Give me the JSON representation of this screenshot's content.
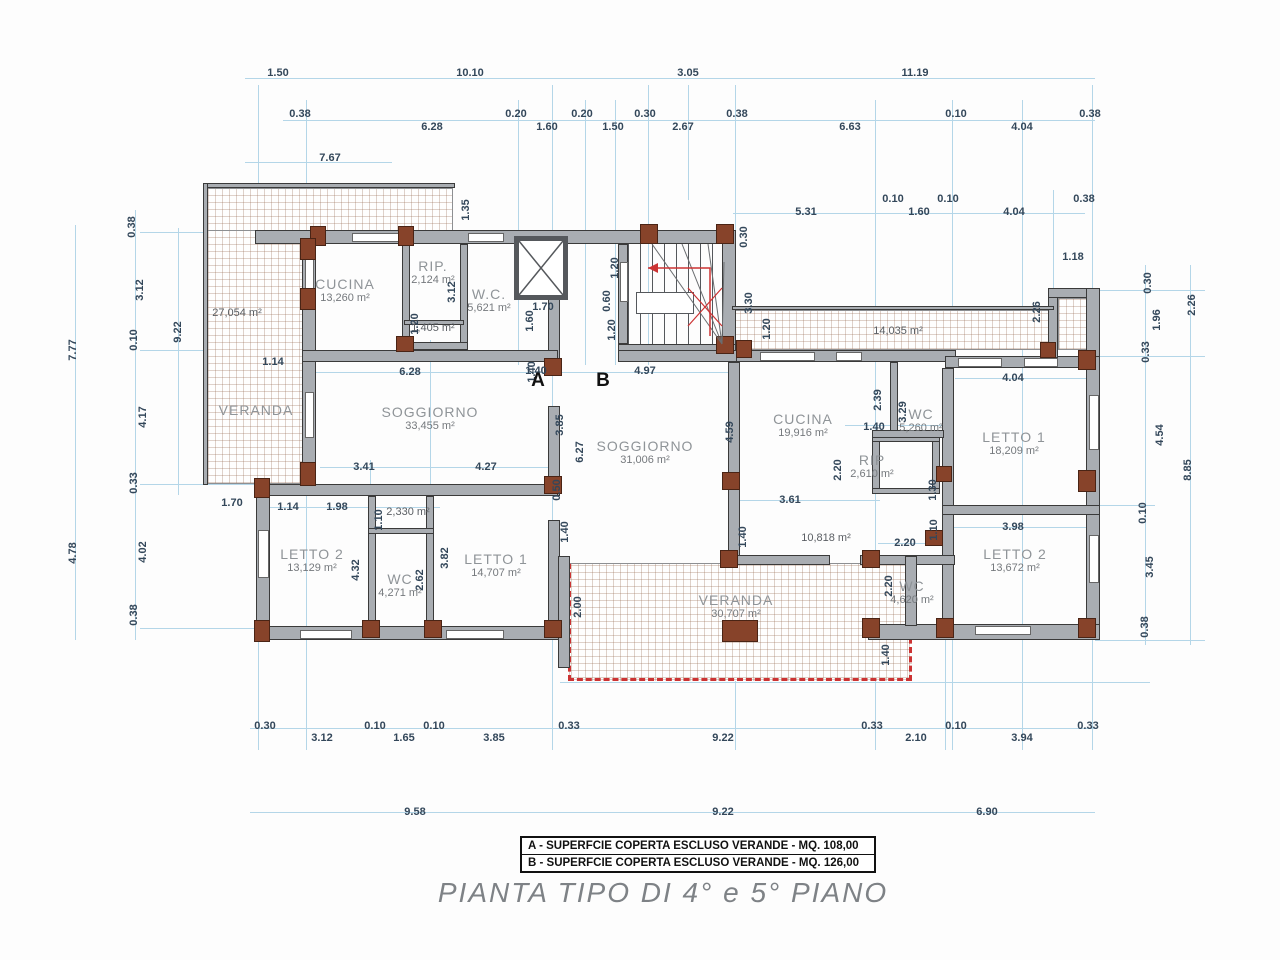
{
  "title": "PIANTA TIPO  DI 4° e 5° PIANO",
  "legend": {
    "items": [
      {
        "label": "A - SUPERFCIE COPERTA ESCLUSO VERANDE - MQ. 108,00"
      },
      {
        "label": "B - SUPERFCIE COPERTA ESCLUSO VERANDE - MQ. 126,00"
      }
    ]
  },
  "markers": [
    {
      "label": "A",
      "x": 538,
      "y": 381
    },
    {
      "label": "B",
      "x": 603,
      "y": 381
    }
  ],
  "rooms": [
    {
      "name": "CUCINA",
      "area": "13,260 m²",
      "x": 345,
      "y": 290
    },
    {
      "name": "RIP.",
      "area": "2,124 m²",
      "x": 433,
      "y": 272
    },
    {
      "name": "W.C.",
      "area": "5,621 m²",
      "x": 489,
      "y": 300
    },
    {
      "name": "",
      "area": "1,405 m²",
      "x": 433,
      "y": 328
    },
    {
      "name": "",
      "area": "27,054 m²",
      "x": 237,
      "y": 313
    },
    {
      "name": "VERANDA",
      "area": "",
      "x": 256,
      "y": 410
    },
    {
      "name": "SOGGIORNO",
      "area": "33,455 m²",
      "x": 430,
      "y": 418
    },
    {
      "name": "LETTO 2",
      "area": "13,129 m²",
      "x": 312,
      "y": 560
    },
    {
      "name": "WC",
      "area": "4,271 m²",
      "x": 400,
      "y": 585
    },
    {
      "name": "",
      "area": "2,330 m²",
      "x": 408,
      "y": 512
    },
    {
      "name": "LETTO 1",
      "area": "14,707 m²",
      "x": 496,
      "y": 565
    },
    {
      "name": "SOGGIORNO",
      "area": "31,006 m²",
      "x": 645,
      "y": 452
    },
    {
      "name": "",
      "area": "14,035 m²",
      "x": 898,
      "y": 331
    },
    {
      "name": "CUCINA",
      "area": "19,916 m²",
      "x": 803,
      "y": 425
    },
    {
      "name": "WC",
      "area": "5,260 m²",
      "x": 921,
      "y": 420
    },
    {
      "name": "RIP",
      "area": "2,610 m²",
      "x": 872,
      "y": 466
    },
    {
      "name": "LETTO 1",
      "area": "18,209 m²",
      "x": 1014,
      "y": 443
    },
    {
      "name": "",
      "area": "10,818 m²",
      "x": 826,
      "y": 538
    },
    {
      "name": "WC",
      "area": "4,620 m²",
      "x": 912,
      "y": 592
    },
    {
      "name": "LETTO 2",
      "area": "13,672 m²",
      "x": 1015,
      "y": 560
    },
    {
      "name": "VERANDA",
      "area": "30,707 m²",
      "x": 736,
      "y": 606
    }
  ],
  "dimensions": [
    {
      "t": "1.50",
      "x": 278,
      "y": 73
    },
    {
      "t": "10.10",
      "x": 470,
      "y": 73
    },
    {
      "t": "3.05",
      "x": 688,
      "y": 73
    },
    {
      "t": "11.19",
      "x": 915,
      "y": 73
    },
    {
      "t": "0.38",
      "x": 300,
      "y": 114
    },
    {
      "t": "6.28",
      "x": 432,
      "y": 127
    },
    {
      "t": "0.20",
      "x": 516,
      "y": 114
    },
    {
      "t": "1.60",
      "x": 547,
      "y": 127
    },
    {
      "t": "0.20",
      "x": 582,
      "y": 114
    },
    {
      "t": "1.50",
      "x": 613,
      "y": 127
    },
    {
      "t": "0.30",
      "x": 645,
      "y": 114
    },
    {
      "t": "2.67",
      "x": 683,
      "y": 127
    },
    {
      "t": "0.38",
      "x": 737,
      "y": 114
    },
    {
      "t": "6.63",
      "x": 850,
      "y": 127
    },
    {
      "t": "0.10",
      "x": 956,
      "y": 114
    },
    {
      "t": "4.04",
      "x": 1022,
      "y": 127
    },
    {
      "t": "0.38",
      "x": 1090,
      "y": 114
    },
    {
      "t": "7.67",
      "x": 330,
      "y": 158
    },
    {
      "t": "5.31",
      "x": 806,
      "y": 212
    },
    {
      "t": "0.10",
      "x": 893,
      "y": 199
    },
    {
      "t": "1.60",
      "x": 919,
      "y": 212
    },
    {
      "t": "0.10",
      "x": 948,
      "y": 199
    },
    {
      "t": "4.04",
      "x": 1014,
      "y": 212
    },
    {
      "t": "0.38",
      "x": 1084,
      "y": 199
    },
    {
      "t": "1.18",
      "x": 1073,
      "y": 257
    },
    {
      "t": "2.26",
      "x": 1037,
      "y": 312,
      "r": 1
    },
    {
      "t": "0.30",
      "x": 744,
      "y": 237,
      "r": 1
    },
    {
      "t": "3.30",
      "x": 749,
      "y": 303,
      "r": 1
    },
    {
      "t": "1.20",
      "x": 767,
      "y": 329,
      "r": 1
    },
    {
      "t": "1.35",
      "x": 466,
      "y": 210,
      "r": 1
    },
    {
      "t": "3.12",
      "x": 452,
      "y": 292,
      "r": 1
    },
    {
      "t": "1.20",
      "x": 415,
      "y": 324,
      "r": 1
    },
    {
      "t": "1.70",
      "x": 543,
      "y": 307
    },
    {
      "t": "1.60",
      "x": 530,
      "y": 321,
      "r": 1
    },
    {
      "t": "1.40",
      "x": 532,
      "y": 372,
      "r": 1
    },
    {
      "t": "1.20",
      "x": 615,
      "y": 268,
      "r": 1
    },
    {
      "t": "0.60",
      "x": 607,
      "y": 301,
      "r": 1
    },
    {
      "t": "1.20",
      "x": 612,
      "y": 330,
      "r": 1
    },
    {
      "t": "1.14",
      "x": 273,
      "y": 362
    },
    {
      "t": "6.28",
      "x": 410,
      "y": 372
    },
    {
      "t": "1.40",
      "x": 536,
      "y": 371
    },
    {
      "t": "4.97",
      "x": 645,
      "y": 371
    },
    {
      "t": "3.85",
      "x": 560,
      "y": 425,
      "r": 1
    },
    {
      "t": "6.27",
      "x": 580,
      "y": 452,
      "r": 1
    },
    {
      "t": "4.59",
      "x": 730,
      "y": 432,
      "r": 1
    },
    {
      "t": "3.41",
      "x": 364,
      "y": 467
    },
    {
      "t": "4.27",
      "x": 486,
      "y": 467
    },
    {
      "t": "0.50",
      "x": 557,
      "y": 490,
      "r": 1
    },
    {
      "t": "1.70",
      "x": 232,
      "y": 503
    },
    {
      "t": "1.14",
      "x": 288,
      "y": 507
    },
    {
      "t": "1.98",
      "x": 337,
      "y": 507
    },
    {
      "t": "1.10",
      "x": 379,
      "y": 520,
      "r": 1
    },
    {
      "t": "4.32",
      "x": 356,
      "y": 570,
      "r": 1
    },
    {
      "t": "3.82",
      "x": 445,
      "y": 558,
      "r": 1
    },
    {
      "t": "2.62",
      "x": 420,
      "y": 580,
      "r": 1
    },
    {
      "t": "2.39",
      "x": 878,
      "y": 400,
      "r": 1
    },
    {
      "t": "3.29",
      "x": 903,
      "y": 412,
      "r": 1
    },
    {
      "t": "1.40",
      "x": 874,
      "y": 427
    },
    {
      "t": "2.20",
      "x": 838,
      "y": 470,
      "r": 1
    },
    {
      "t": "3.61",
      "x": 790,
      "y": 500
    },
    {
      "t": "4.04",
      "x": 1013,
      "y": 378
    },
    {
      "t": "1.30",
      "x": 933,
      "y": 490,
      "r": 1
    },
    {
      "t": "1.10",
      "x": 934,
      "y": 530,
      "r": 1
    },
    {
      "t": "3.98",
      "x": 1013,
      "y": 527
    },
    {
      "t": "2.20",
      "x": 905,
      "y": 543
    },
    {
      "t": "2.20",
      "x": 889,
      "y": 586,
      "r": 1
    },
    {
      "t": "1.40",
      "x": 886,
      "y": 655,
      "r": 1
    },
    {
      "t": "1.40",
      "x": 743,
      "y": 537,
      "r": 1
    },
    {
      "t": "1.40",
      "x": 565,
      "y": 532,
      "r": 1
    },
    {
      "t": "2.00",
      "x": 578,
      "y": 607,
      "r": 1
    },
    {
      "t": "7.77",
      "x": 73,
      "y": 350,
      "r": 1
    },
    {
      "t": "4.78",
      "x": 73,
      "y": 553,
      "r": 1
    },
    {
      "t": "0.38",
      "x": 132,
      "y": 227,
      "r": 1
    },
    {
      "t": "3.12",
      "x": 140,
      "y": 290,
      "r": 1
    },
    {
      "t": "0.10",
      "x": 134,
      "y": 340,
      "r": 1
    },
    {
      "t": "4.17",
      "x": 143,
      "y": 417,
      "r": 1
    },
    {
      "t": "0.33",
      "x": 134,
      "y": 483,
      "r": 1
    },
    {
      "t": "4.02",
      "x": 143,
      "y": 552,
      "r": 1
    },
    {
      "t": "0.38",
      "x": 134,
      "y": 615,
      "r": 1
    },
    {
      "t": "9.22",
      "x": 178,
      "y": 332,
      "r": 1
    },
    {
      "t": "0.30",
      "x": 1148,
      "y": 283,
      "r": 1
    },
    {
      "t": "1.96",
      "x": 1157,
      "y": 320,
      "r": 1
    },
    {
      "t": "2.26",
      "x": 1192,
      "y": 305,
      "r": 1
    },
    {
      "t": "0.33",
      "x": 1146,
      "y": 352,
      "r": 1
    },
    {
      "t": "4.54",
      "x": 1160,
      "y": 435,
      "r": 1
    },
    {
      "t": "8.85",
      "x": 1188,
      "y": 470,
      "r": 1
    },
    {
      "t": "0.10",
      "x": 1143,
      "y": 513,
      "r": 1
    },
    {
      "t": "3.45",
      "x": 1150,
      "y": 567,
      "r": 1
    },
    {
      "t": "0.38",
      "x": 1145,
      "y": 627,
      "r": 1
    },
    {
      "t": "0.30",
      "x": 265,
      "y": 726
    },
    {
      "t": "3.12",
      "x": 322,
      "y": 738
    },
    {
      "t": "0.10",
      "x": 375,
      "y": 726
    },
    {
      "t": "1.65",
      "x": 404,
      "y": 738
    },
    {
      "t": "0.10",
      "x": 434,
      "y": 726
    },
    {
      "t": "3.85",
      "x": 494,
      "y": 738
    },
    {
      "t": "0.33",
      "x": 569,
      "y": 726
    },
    {
      "t": "9.22",
      "x": 723,
      "y": 738
    },
    {
      "t": "0.33",
      "x": 872,
      "y": 726
    },
    {
      "t": "2.10",
      "x": 916,
      "y": 738
    },
    {
      "t": "0.10",
      "x": 956,
      "y": 726
    },
    {
      "t": "3.94",
      "x": 1022,
      "y": 738
    },
    {
      "t": "0.33",
      "x": 1088,
      "y": 726
    },
    {
      "t": "9.58",
      "x": 415,
      "y": 812
    },
    {
      "t": "9.22",
      "x": 723,
      "y": 812
    },
    {
      "t": "6.90",
      "x": 987,
      "y": 812
    }
  ],
  "colors": {
    "dimension_line": "#b4d6e8",
    "dimension_text": "#33475a",
    "wall_fill": "#a9adb2",
    "wall_edge": "#3a3a3a",
    "column": "#87432a",
    "hatch_line": "#9a6a4a",
    "railing_red": "#cc3333",
    "room_text": "#8f9498",
    "title_text": "#7e8286"
  }
}
